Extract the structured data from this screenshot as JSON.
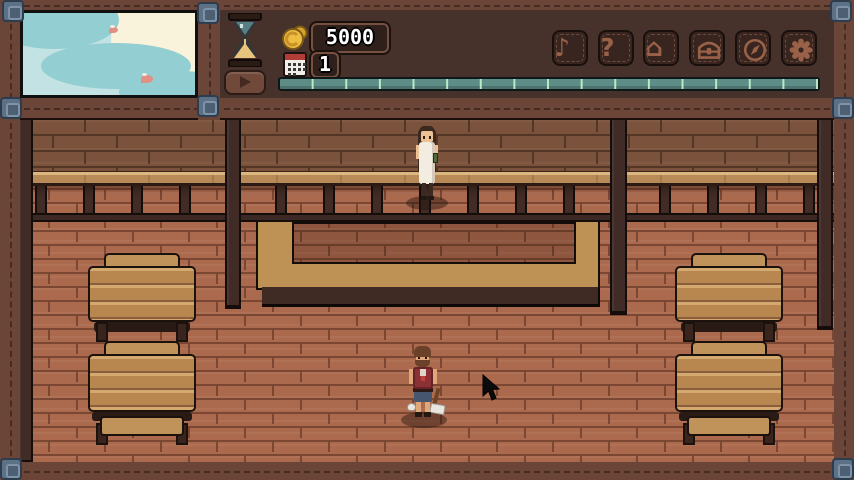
{
  "hud": {
    "money": {
      "value": "5000",
      "icon": "coin-icon"
    },
    "day": {
      "value": "1",
      "icon": "calendar-icon"
    },
    "time": {
      "icon": "hourglass-icon",
      "play_icon": "play-icon",
      "bar_segments": 16,
      "bar_color": "#5e8d87",
      "tick_color": "#bbe9c6"
    },
    "menu": [
      {
        "name": "music",
        "icon": "music-note-icon",
        "glyph": "♪"
      },
      {
        "name": "help",
        "icon": "question-mark-icon",
        "glyph": "?"
      },
      {
        "name": "home",
        "icon": "house-icon",
        "glyph": "⌂"
      },
      {
        "name": "storage",
        "icon": "chest-icon"
      },
      {
        "name": "map",
        "icon": "compass-icon"
      },
      {
        "name": "settings",
        "icon": "gear-icon"
      }
    ]
  },
  "sky_view": {
    "sun": true,
    "bird_count": 2,
    "sky_color": "#c3e2e4",
    "cloud_color": "#93ced3",
    "sun_color": "#f8f3da"
  },
  "scene": {
    "characters": [
      {
        "name": "guest-on-balcony",
        "outfit": "white-dress",
        "x": 392,
        "y": 4
      },
      {
        "name": "innkeeper",
        "outfit": "red-vest",
        "x": 386,
        "y": 228
      }
    ],
    "beds": [
      {
        "type": "bed-upper",
        "x": 68,
        "y": 135
      },
      {
        "type": "bed-lower",
        "x": 68,
        "y": 223
      },
      {
        "type": "bed-upper",
        "x": 655,
        "y": 135
      },
      {
        "type": "bed-lower",
        "x": 655,
        "y": 223
      }
    ],
    "cursor": {
      "x": 462,
      "y": 256
    }
  },
  "colors": {
    "frame_wood": "#6a4538",
    "panel_bg": "#46312b",
    "brick_lower": "#ab6a4e",
    "brick_upper": "#7b523c",
    "balcony_floor": "#b78a58",
    "beam": "#3c2824",
    "stair_wood": "#bd9254",
    "bed_plank": "#b8864f",
    "metal_corner": "#5d7186"
  }
}
